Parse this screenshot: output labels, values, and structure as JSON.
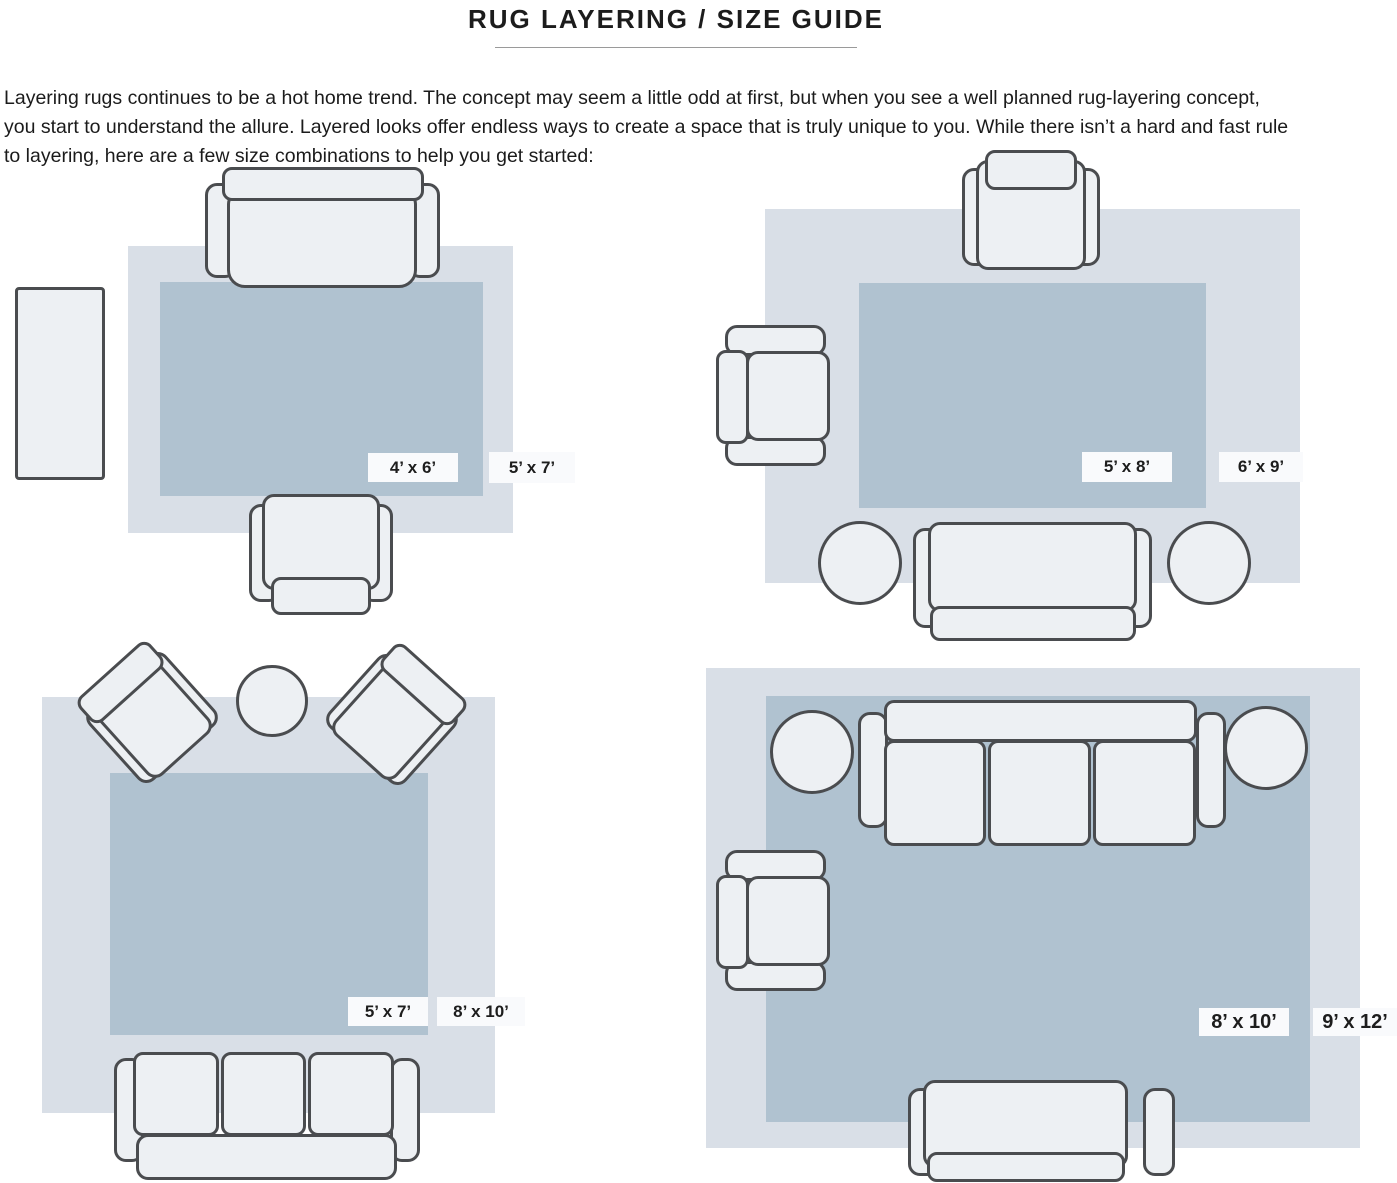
{
  "header": {
    "title": "RUG LAYERING / SIZE GUIDE",
    "intro_lines": [
      "Layering rugs continues to be a hot home trend. The concept may seem a little odd at first, but when you see a well planned rug-layering concept,",
      "you start to understand the allure. Layered looks offer endless ways to create a space that is truly unique to you. While there isn’t a hard and fast rule",
      "to layering, here are a few size combinations to help you get started:"
    ]
  },
  "colors": {
    "outer_rug": "#d9dfe7",
    "inner_rug": "#b0c2d0",
    "furniture_fill": "#edf0f3",
    "furniture_outline": "#4a4c4f",
    "label_background": "#f9fafc",
    "text": "#1d1d1d"
  },
  "diagrams": [
    {
      "position": "top-left",
      "inner_label": "4’ x 6’",
      "outer_label": "5’ x 7’",
      "furniture": [
        "sofa",
        "armchair",
        "side-table"
      ]
    },
    {
      "position": "top-right",
      "inner_label": "5’ x 8’",
      "outer_label": "6’ x 9’",
      "furniture": [
        "armchair",
        "armchair",
        "sofa",
        "round-table",
        "round-table"
      ]
    },
    {
      "position": "bottom-left",
      "inner_label": "5’ x 7’",
      "outer_label": "8’ x 10’",
      "furniture": [
        "angled-armchair",
        "angled-armchair",
        "round-table",
        "three-seat-sofa"
      ]
    },
    {
      "position": "bottom-right",
      "inner_label": "8’ x 10’",
      "outer_label": "9’ x 12’",
      "furniture": [
        "three-seat-sofa",
        "sofa",
        "armchair",
        "round-table",
        "round-table"
      ]
    }
  ]
}
